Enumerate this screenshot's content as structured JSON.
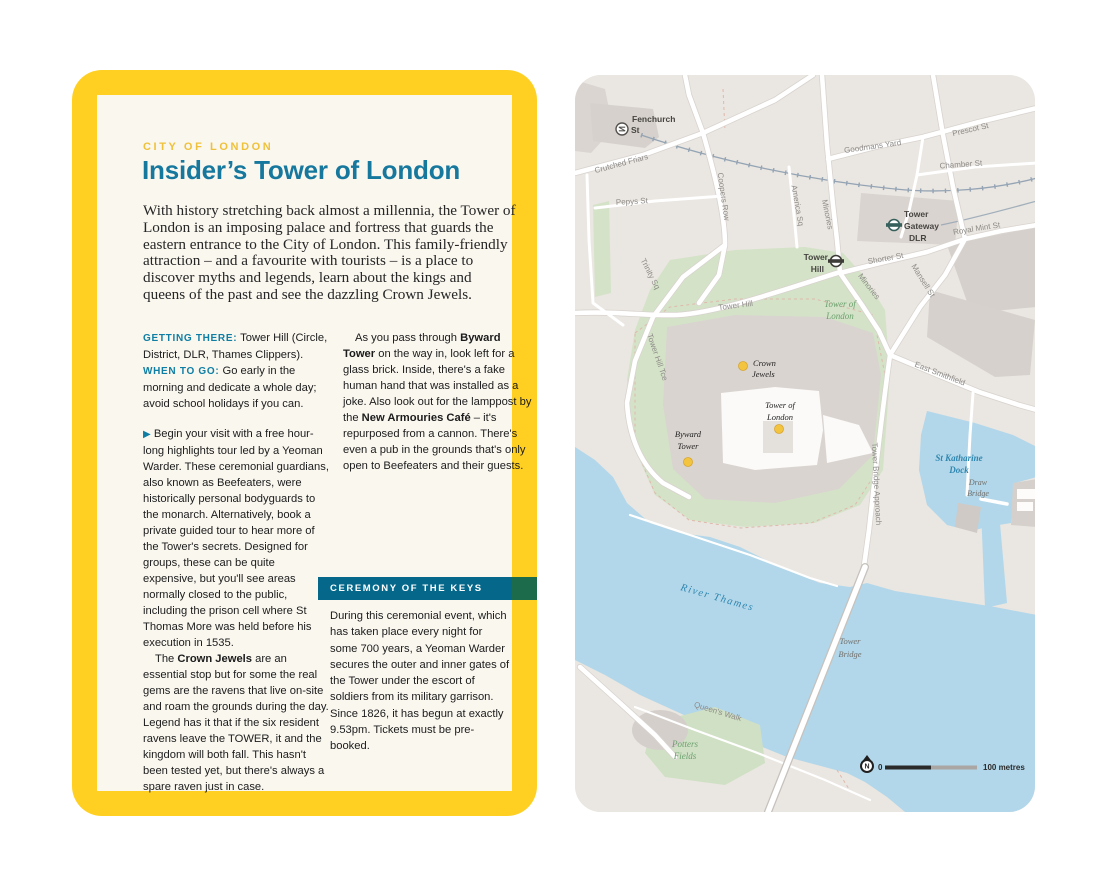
{
  "card": {
    "eyebrow": "CITY OF LONDON",
    "title": "Insider’s Tower of London",
    "intro": "With history stretching back almost a millennia, the Tower of London is an imposing palace and fortress that guards the eastern entrance to the City of London. This family-friendly attraction – and a favourite with tourists – is a place to discover myths and legends, learn about the kings and queens of the past and see the dazzling Crown Jewels.",
    "getting_there_label": "GETTING THERE:",
    "getting_there_text": " Tower Hill (Circle, District, DLR, Thames Clippers).",
    "when_to_go_label": "WHEN TO GO:",
    "when_to_go_text": " Go early in the morning and dedicate a whole day; avoid school holidays if you can.",
    "para1_arrow": "▶",
    "para1": "Begin your visit with a free hour-long highlights tour led by a Yeoman Warder. These ceremonial guardians, also known as Beefeaters, were historically personal bodyguards to the monarch. Alternatively, book a private guided tour to hear more of the Tower's secrets. Designed for groups, these can be quite expensive, but you'll see areas normally closed to the public, including the prison cell where St Thomas More was held before his execution in 1535.",
    "para2_pre": "The ",
    "para2_bold": "Crown Jewels",
    "para2_post": " are an essential stop but for some the real gems are the ravens that live on-site and roam the grounds during the day. Legend has it that if the six resident ravens leave the TOWER, it and the kingdom will both fall. This hasn't been tested yet, but there's always a spare raven just in case.",
    "para3_pre": "As you pass through ",
    "para3_bold1": "Byward Tower",
    "para3_mid": " on the way in, look left for a glass brick. Inside, there's a fake human hand that was installed as a joke. Also look out for the lamppost by the ",
    "para3_bold2": "New Armouries Café",
    "para3_post": " – it's repurposed from a cannon. There's even a pub in the grounds that's only open to Beefeaters and their guests.",
    "box": {
      "title": "CEREMONY OF THE KEYS",
      "body": "During this ceremonial event, which has taken place every night for some 700 years, a Yeoman Warder secures the outer and inner gates of the Tower under the escort of soldiers from its military garrison. Since 1826, it has begun at exactly 9.53pm. Tickets must be pre-booked."
    },
    "colors": {
      "border": "#FFD021",
      "paper": "#FAF7EF",
      "accent_teal": "#17789E",
      "accent_gold": "#EFC13B",
      "box_teal": "#05688B",
      "box_green": "#1C6B4B"
    }
  },
  "map": {
    "streets": [
      "Crutched Friars",
      "Pepys St",
      "Coopers Row",
      "Trinity Sq",
      "America Sq",
      "Minories",
      "Tower Hill",
      "Tower Hill Tce",
      "Goodmans Yard",
      "Prescot St",
      "Chamber St",
      "Royal Mint St",
      "Shorter St",
      "Minories",
      "Mansell St",
      "East Smithfield",
      "Tower Bridge Approach",
      "Queen's Walk"
    ],
    "stations": [
      {
        "name": "Fenchurch St",
        "lines": [
          "Fenchurch",
          "St"
        ]
      },
      {
        "name": "Tower Hill",
        "lines": [
          "Tower",
          "Hill"
        ]
      },
      {
        "name": "Tower Gateway DLR",
        "lines": [
          "Tower",
          "Gateway",
          "DLR"
        ]
      }
    ],
    "pois": [
      {
        "name": "Crown Jewels",
        "lines": [
          "Crown",
          "Jewels"
        ]
      },
      {
        "name": "Tower of London",
        "lines": [
          "Tower of",
          "London"
        ]
      },
      {
        "name": "Byward Tower",
        "lines": [
          "Byward",
          "Tower"
        ]
      }
    ],
    "areas": [
      {
        "name": "Tower of London",
        "lines": [
          "Tower of",
          "London"
        ]
      },
      {
        "name": "Potters Fields",
        "lines": [
          "Potters",
          "Fields"
        ]
      }
    ],
    "water_labels": [
      {
        "name": "River Thames",
        "lines": [
          "River Thames"
        ]
      },
      {
        "name": "St Katharine Dock",
        "lines": [
          "St Katharine",
          "Dock"
        ]
      },
      {
        "name": "Draw Bridge",
        "lines": [
          "Draw",
          "Bridge"
        ]
      },
      {
        "name": "Tower Bridge",
        "lines": [
          "Tower",
          "Bridge"
        ]
      }
    ],
    "scale": {
      "zero": "0",
      "distance": "100 metres",
      "north_letter": "N"
    },
    "colors": {
      "land": "#EAE6E1",
      "water": "#B2D7EA",
      "park": "#D4E3C8",
      "poi_dot": "#F3C43F"
    }
  }
}
